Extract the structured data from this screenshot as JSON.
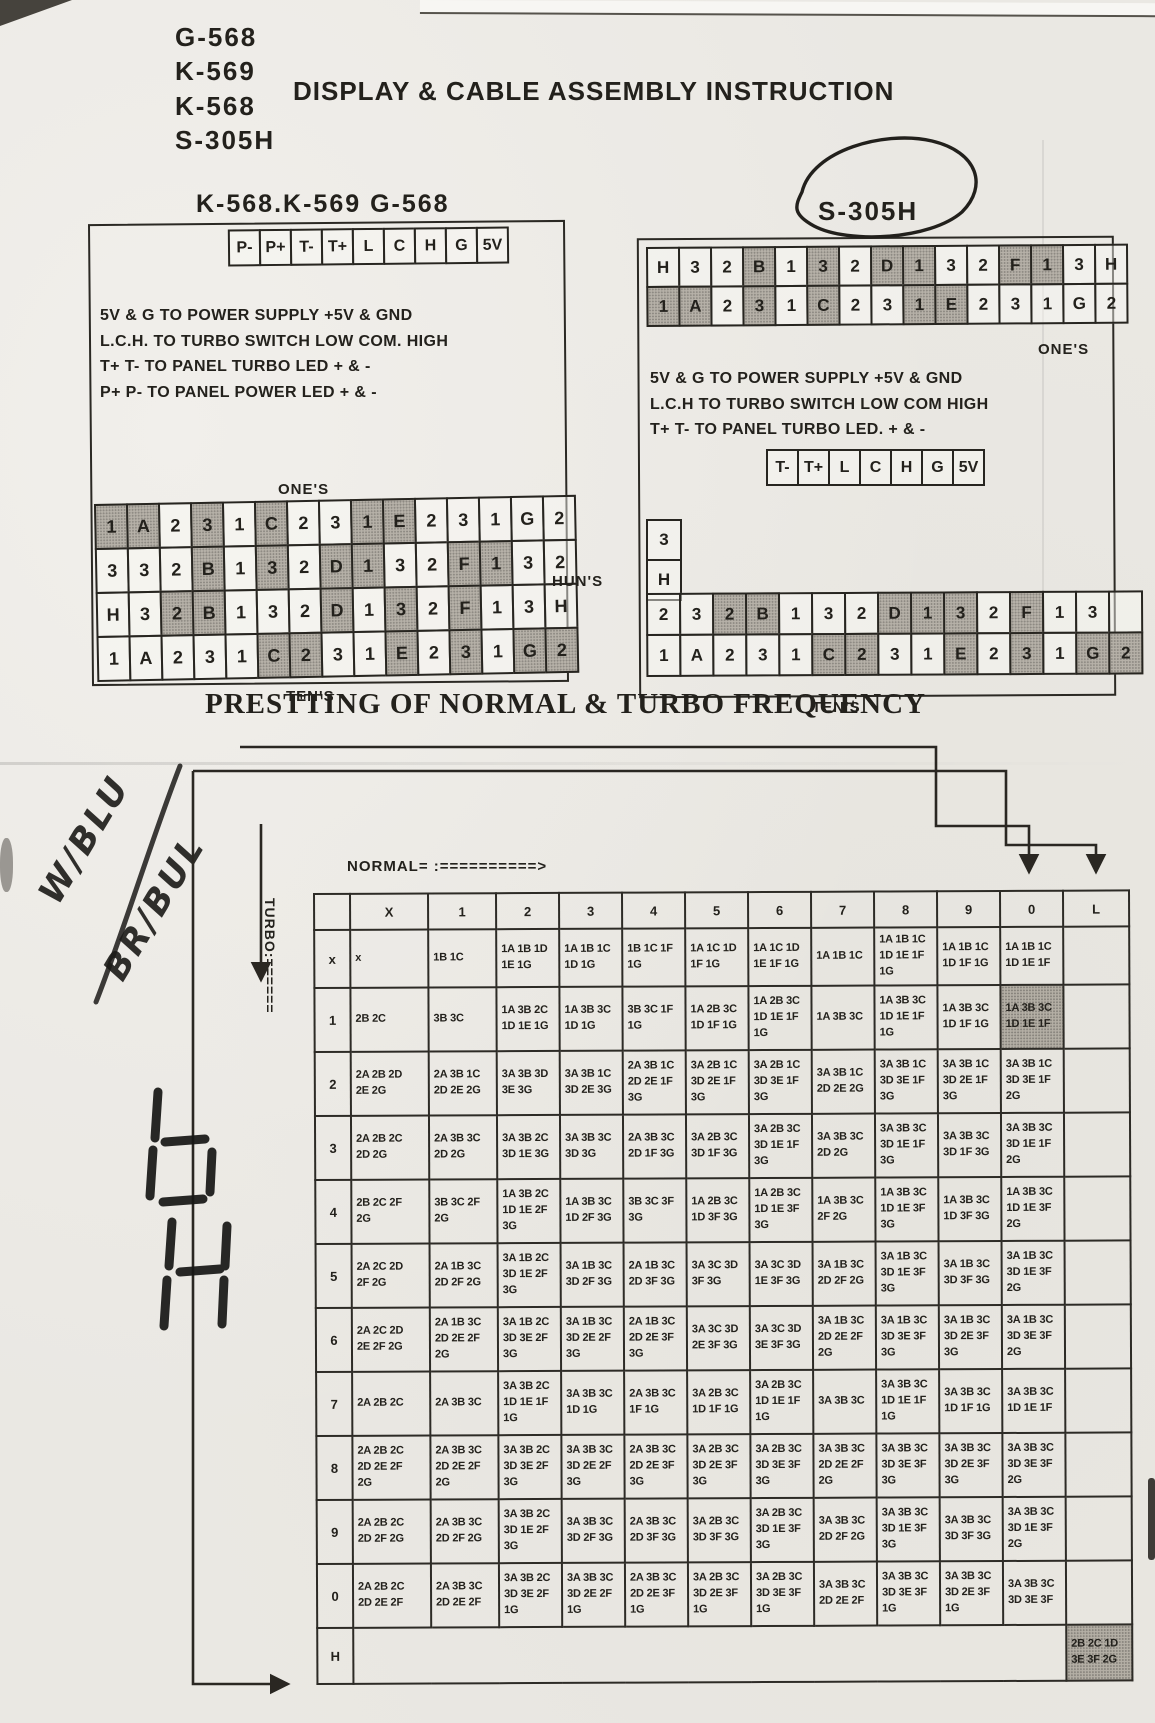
{
  "header": {
    "models": [
      "G-568",
      "K-569",
      "K-568",
      "S-305H"
    ],
    "title": "DISPLAY & CABLE ASSEMBLY INSTRUCTION"
  },
  "left_panel": {
    "heading": "K-568.K-569 G-568",
    "connector_pins": [
      "P-",
      "P+",
      "T-",
      "T+",
      "L",
      "C",
      "H",
      "G",
      "5V"
    ],
    "notes": [
      "5V & G TO POWER SUPPLY +5V & GND",
      "L.C.H. TO TURBO SWITCH LOW COM. HIGH",
      "T+ T- TO PANEL TURBO LED + & -",
      "P+ P- TO PANEL POWER LED + & -"
    ],
    "ones_label": "ONE'S",
    "tens_label": "TEN'S",
    "digit_grid": [
      [
        "#1",
        "#A",
        "2",
        "#3",
        "1",
        "#C",
        "2",
        "3",
        "#1",
        "#E",
        "2",
        "3",
        "1",
        "G",
        "2"
      ],
      [
        "3",
        "3",
        "2",
        "#B",
        "1",
        "#3",
        "2",
        "#D",
        "#1",
        "3",
        "2",
        "#F",
        "#1",
        "3",
        "2"
      ],
      [
        "H",
        "3",
        "#2",
        "#B",
        "1",
        "3",
        "2",
        "#D",
        "1",
        "#3",
        "2",
        "#F",
        "1",
        "3",
        "H"
      ],
      [
        "1",
        "A",
        "2",
        "3",
        "1",
        "#C",
        "#2",
        "3",
        "1",
        "#E",
        "2",
        "#3",
        "1",
        "#G",
        "#2"
      ]
    ]
  },
  "huns_label": "HUN'S",
  "right_panel": {
    "heading": "S-305H",
    "ones_label": "ONE'S",
    "tens_label": "TEN'S",
    "top_grid": [
      [
        "H",
        "3",
        "2",
        "#B",
        "1",
        "#3",
        "2",
        "#D",
        "#1",
        "3",
        "2",
        "#F",
        "#1",
        "3",
        "H"
      ],
      [
        "#1",
        "#A",
        "2",
        "#3",
        "1",
        "#C",
        "2",
        "3",
        "#1",
        "#E",
        "2",
        "3",
        "1",
        "G",
        "2"
      ]
    ],
    "notes": [
      "5V & G TO POWER SUPPLY +5V & GND",
      "L.C.H TO TURBO SWITCH LOW COM HIGH",
      "T+ T- TO PANEL TURBO LED. + & -"
    ],
    "connector_pins": [
      "T-",
      "T+",
      "L",
      "C",
      "H",
      "G",
      "5V"
    ],
    "side_cells": [
      "3",
      "H"
    ],
    "bottom_grid": [
      [
        "2",
        "3",
        "#2",
        "#B",
        "1",
        "3",
        "2",
        "#D",
        "#1",
        "#3",
        "2",
        "#F",
        "1",
        "3",
        ""
      ],
      [
        "1",
        "A",
        "2",
        "3",
        "1",
        "#C",
        "#2",
        "3",
        "1",
        "#E",
        "2",
        "#3",
        "1",
        "#G",
        "#2"
      ]
    ]
  },
  "frequency_table": {
    "title": "PRESTTING OF NORMAL & TURBO FREQUENCY",
    "normal_axis_label": "NORMAL= :==========>",
    "turbo_axis_label": "TURBO:======",
    "col_headers": [
      "",
      "X",
      "1",
      "2",
      "3",
      "4",
      "5",
      "6",
      "7",
      "8",
      "9",
      "0",
      "L"
    ],
    "rows": [
      {
        "label": "x",
        "cells": [
          "x",
          "1B 1C",
          "1A 1B 1D 1E 1G",
          "1A 1B 1C 1D 1G",
          "1B 1C 1F 1G",
          "1A 1C 1D 1F 1G",
          "1A 1C 1D 1E 1F 1G",
          "1A 1B 1C",
          "1A 1B 1C 1D 1E 1F 1G",
          "1A 1B 1C 1D 1F 1G",
          "1A 1B 1C 1D 1E 1F",
          ""
        ]
      },
      {
        "label": "1",
        "cells": [
          "2B 2C",
          "3B 3C",
          "1A 3B 2C 1D 1E 1G",
          "1A 3B 3C 1D 1G",
          "3B 3C 1F 1G",
          "1A 2B 3C 1D 1F 1G",
          "1A 2B 3C 1D 1E 1F 1G",
          "1A 3B 3C",
          "1A 3B 3C 1D 1E 1F 1G",
          "1A 3B 3C 1D 1F 1G",
          "#1A 3B 3C 1D 1E 1F",
          ""
        ]
      },
      {
        "label": "2",
        "cells": [
          "2A 2B 2D 2E 2G",
          "2A 3B 1C 2D 2E 2G",
          "3A 3B 3D 3E 3G",
          "3A 3B 1C 3D 2E 3G",
          "2A 3B 1C 2D 2E 1F 3G",
          "3A 2B 1C 3D 2E 1F 3G",
          "3A 2B 1C 3D 3E 1F 3G",
          "3A 3B 1C 2D 2E 2G",
          "3A 3B 1C 3D 3E 1F 3G",
          "3A 3B 1C 3D 2E 1F 3G",
          "3A 3B 1C 3D 3E 1F 2G",
          ""
        ]
      },
      {
        "label": "3",
        "cells": [
          "2A 2B 2C 2D 2G",
          "2A 3B 3C 2D 2G",
          "3A 3B 2C 3D 1E 3G",
          "3A 3B 3C 3D 3G",
          "2A 3B 3C 2D 1F 3G",
          "3A 2B 3C 3D 1F 3G",
          "3A 2B 3C 3D 1E 1F 3G",
          "3A 3B 3C 2D 2G",
          "3A 3B 3C 3D 1E 1F 3G",
          "3A 3B 3C 3D 1F 3G",
          "3A 3B 3C 3D 1E 1F 2G",
          ""
        ]
      },
      {
        "label": "4",
        "cells": [
          "2B 2C 2F 2G",
          "3B 3C 2F 2G",
          "1A 3B 2C 1D 1E 2F 3G",
          "1A 3B 3C 1D 2F 3G",
          "3B 3C 3F 3G",
          "1A 2B 3C 1D 3F 3G",
          "1A 2B 3C 1D 1E 3F 3G",
          "1A 3B 3C 2F 2G",
          "1A 3B 3C 1D 1E 3F 3G",
          "1A 3B 3C 1D 3F 3G",
          "1A 3B 3C 1D 1E 3F 2G",
          ""
        ]
      },
      {
        "label": "5",
        "cells": [
          "2A 2C 2D 2F 2G",
          "2A 1B 3C 2D 2F 2G",
          "3A 1B 2C 3D 1E 2F 3G",
          "3A 1B 3C 3D 2F 3G",
          "2A 1B 3C 2D 3F 3G",
          "3A 3C 3D 3F 3G",
          "3A 3C 3D 1E 3F 3G",
          "3A 1B 3C 2D 2F 2G",
          "3A 1B 3C 3D 1E 3F 3G",
          "3A 1B 3C 3D 3F 3G",
          "3A 1B 3C 3D 1E 3F 2G",
          ""
        ]
      },
      {
        "label": "6",
        "cells": [
          "2A 2C 2D 2E 2F 2G",
          "2A 1B 3C 2D 2E 2F 2G",
          "3A 1B 2C 3D 3E 2F 3G",
          "3A 1B 3C 3D 2E 2F 3G",
          "2A 1B 3C 2D 2E 3F 3G",
          "3A 3C 3D 2E 3F 3G",
          "3A 3C 3D 3E 3F 3G",
          "3A 1B 3C 2D 2E 2F 2G",
          "3A 1B 3C 3D 3E 3F 3G",
          "3A 1B 3C 3D 2E 3F 3G",
          "3A 1B 3C 3D 3E 3F 2G",
          ""
        ]
      },
      {
        "label": "7",
        "cells": [
          "2A 2B 2C",
          "2A 3B 3C",
          "3A 3B 2C 1D 1E 1F 1G",
          "3A 3B 3C 1D 1G",
          "2A 3B 3C 1F 1G",
          "3A 2B 3C 1D 1F 1G",
          "3A 2B 3C 1D 1E 1F 1G",
          "3A 3B 3C",
          "3A 3B 3C 1D 1E 1F 1G",
          "3A 3B 3C 1D 1F 1G",
          "3A 3B 3C 1D 1E 1F",
          ""
        ]
      },
      {
        "label": "8",
        "cells": [
          "2A 2B 2C 2D 2E 2F 2G",
          "2A 3B 3C 2D 2E 2F 2G",
          "3A 3B 2C 3D 3E 2F 3G",
          "3A 3B 3C 3D 2E 2F 3G",
          "2A 3B 3C 2D 2E 3F 3G",
          "3A 2B 3C 3D 2E 3F 3G",
          "3A 2B 3C 3D 3E 3F 3G",
          "3A 3B 3C 2D 2E 2F 2G",
          "3A 3B 3C 3D 3E 3F 3G",
          "3A 3B 3C 3D 2E 3F 3G",
          "3A 3B 3C 3D 3E 3F 2G",
          ""
        ]
      },
      {
        "label": "9",
        "cells": [
          "2A 2B 2C 2D 2F 2G",
          "2A 3B 3C 2D 2F 2G",
          "3A 3B 2C 3D 1E 2F 3G",
          "3A 3B 3C 3D 2F 3G",
          "2A 3B 3C 2D 3F 3G",
          "3A 2B 3C 3D 3F 3G",
          "3A 2B 3C 3D 1E 3F 3G",
          "3A 3B 3C 2D 2F 2G",
          "3A 3B 3C 3D 1E 3F 3G",
          "3A 3B 3C 3D 3F 3G",
          "3A 3B 3C 3D 1E 3F 2G",
          ""
        ]
      },
      {
        "label": "0",
        "cells": [
          "2A 2B 2C 2D 2E 2F",
          "2A 3B 3C 2D 2E 2F",
          "3A 3B 2C 3D 3E 2F 1G",
          "3A 3B 3C 3D 2E 2F 1G",
          "2A 3B 3C 2D 2E 3F 1G",
          "3A 2B 3C 3D 2E 3F 1G",
          "3A 2B 3C 3D 3E 3F 1G",
          "3A 3B 3C 2D 2E 2F",
          "3A 3B 3C 3D 3E 3F 1G",
          "3A 3B 3C 3D 2E 3F 1G",
          "3A 3B 3C 3D 3E 3F",
          ""
        ]
      },
      {
        "label": "H",
        "cells": [
          {
            "t": "",
            "span": 11
          },
          "#2B 2C 1D 3E 3F 2G"
        ]
      }
    ]
  },
  "handwriting": {
    "line1": "W/BLU",
    "line2": "BR/BUL"
  }
}
